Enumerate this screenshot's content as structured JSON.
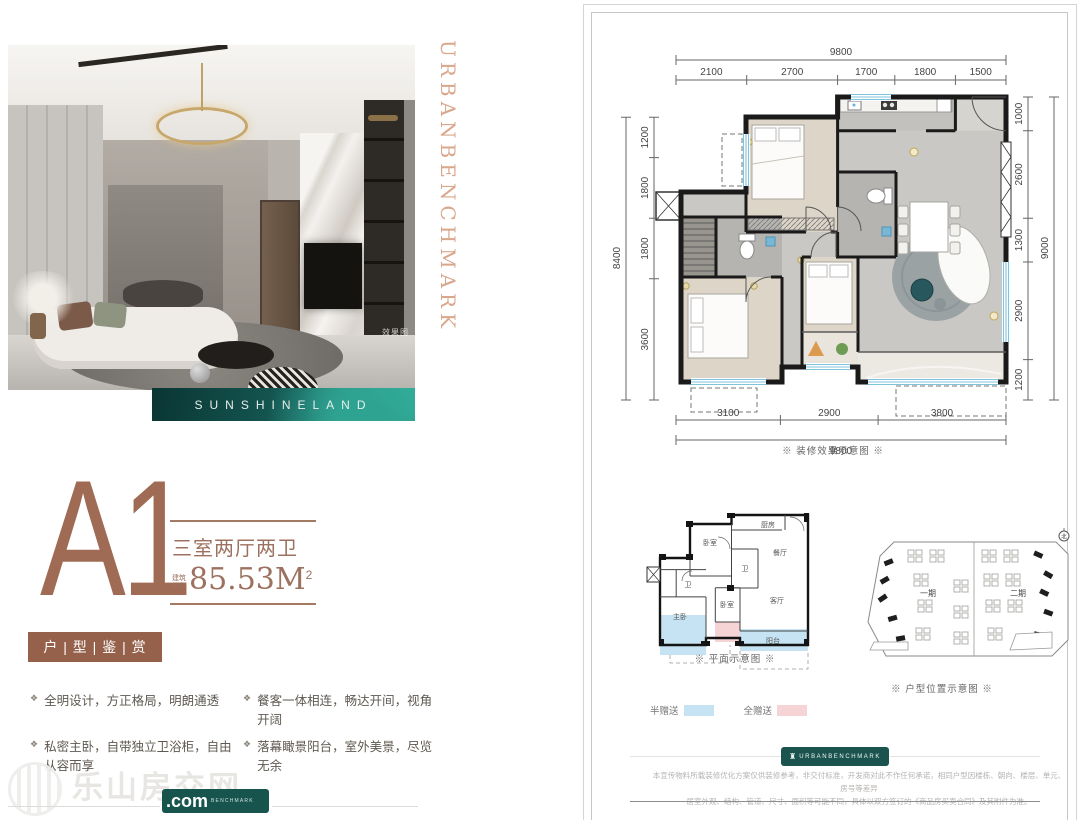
{
  "hero": {
    "brand_vertical": "URBANBENCHMARK",
    "photo_tag": "效果图",
    "banner_text": "SUNSHINELAND"
  },
  "unit": {
    "code": "A1",
    "layout": "三室两厅两卫",
    "area_label_top": "建筑",
    "area_label_bottom": "面积",
    "area_value": "85.53M",
    "area_exponent": "2",
    "badge": "户 | 型 | 鉴 | 赏"
  },
  "features": {
    "marker": "❖",
    "left": [
      "全明设计，方正格局，明朗通透",
      "私密主卧，自带独立卫浴柜，自由从容而享"
    ],
    "right": [
      "餐客一体相连，畅达开间，视角开阔",
      "落幕瞰景阳台，室外美景，尽览无余"
    ]
  },
  "watermark": {
    "site": "乐山房交网",
    "com": ".com",
    "badge": "BENCHMARK"
  },
  "plan": {
    "caption": "※ 装修效果示意图 ※",
    "top_total": "9800",
    "top": [
      "2100",
      "2700",
      "1700",
      "1800",
      "1500"
    ],
    "bottom": [
      "3100",
      "2900",
      "3800"
    ],
    "bottom_total": "9800",
    "left_total": "8400",
    "left": [
      "1200",
      "1800",
      "1800",
      "3600"
    ],
    "right": [
      "1000",
      "2600",
      "1300",
      "2900",
      "1200"
    ],
    "right_total": "9000"
  },
  "small_plan": {
    "caption": "※ 平面示意图 ※",
    "labels": {
      "bed_top": "卧室",
      "bath_mid": "卫",
      "kitchen": "厨房",
      "dining": "餐厅",
      "bath_left": "卫",
      "master": "主卧",
      "bed_mid": "卧室",
      "living": "客厅",
      "balcony": "阳台"
    },
    "legend": [
      {
        "label": "半赠送"
      },
      {
        "label": "全赠送"
      }
    ]
  },
  "site_plan": {
    "caption": "※ 户型位置示意图 ※",
    "phase_1": "一期",
    "phase_2": "二期",
    "north": "北"
  },
  "footer": {
    "badge": "URBANBENCHMARK",
    "disclaimer_1": "本宣传物料所载装修优化方案仅供装修参考，非交付标准，开发商对此不作任何承诺，相同户型因楼栋、朝向、楼层、单元、房号等差异",
    "disclaimer_2": "居室外观、结构、管道、尺寸、面积等可能不同，具体以双方签订的《商品房买卖合同》及其附件为准。"
  },
  "colors": {
    "copper": "#a06b54",
    "brown_badge": "#96614b",
    "teal": "#1b544e",
    "window_blue": "#7fc4dd",
    "legend_blue": "#c5e3f2",
    "legend_pink": "#f6d3d4"
  }
}
